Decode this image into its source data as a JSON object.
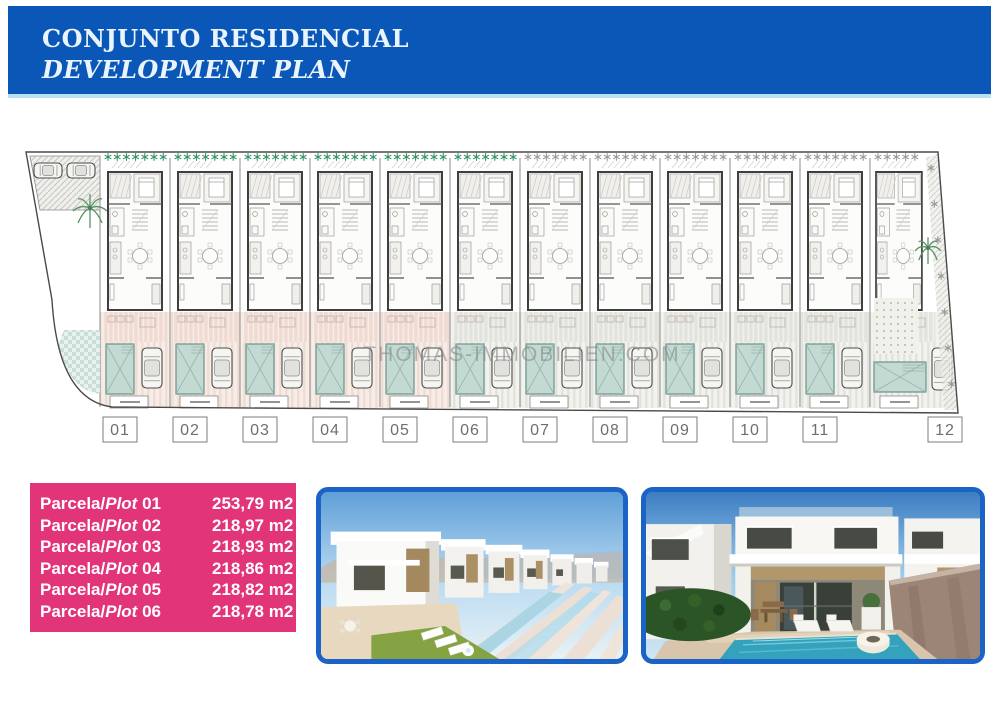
{
  "header": {
    "title_line1": "CONJUNTO RESIDENCIAL",
    "title_line2": "DEVELOPMENT PLAN",
    "bg_color": "#0a57b7",
    "accent_color": "#b7e0f1",
    "text_color": "#eaf4fc"
  },
  "site_plan": {
    "watermark": "THOMAS-IMMOBILIEN.COM",
    "colors": {
      "star_green": "#2f9466",
      "star_gray": "#9b9b9b",
      "pool_fill": "#c3dad3",
      "pool_stroke": "#6a938b",
      "boundary": "#4a4a4a",
      "phase_pink": "#f7ece6",
      "phase_gray": "#f2f2ef"
    },
    "units": [
      {
        "number": "01",
        "ground": "pink",
        "stars": "green"
      },
      {
        "number": "02",
        "ground": "pink",
        "stars": "green"
      },
      {
        "number": "03",
        "ground": "pink",
        "stars": "green"
      },
      {
        "number": "04",
        "ground": "pink",
        "stars": "green"
      },
      {
        "number": "05",
        "ground": "pink",
        "stars": "green"
      },
      {
        "number": "06",
        "ground": "gray",
        "stars": "green"
      },
      {
        "number": "07",
        "ground": "gray",
        "stars": "gray"
      },
      {
        "number": "08",
        "ground": "gray",
        "stars": "gray"
      },
      {
        "number": "09",
        "ground": "gray",
        "stars": "gray"
      },
      {
        "number": "10",
        "ground": "gray",
        "stars": "gray"
      },
      {
        "number": "11",
        "ground": "gray",
        "stars": "gray"
      },
      {
        "number": "12",
        "ground": "gray",
        "stars": "gray"
      }
    ]
  },
  "plot_table": {
    "bg_color": "#e23478",
    "rows": [
      {
        "prefix": "Parcela/",
        "word": "Plot",
        "num": "01",
        "area": "253,79 m2"
      },
      {
        "prefix": "Parcela/",
        "word": "Plot",
        "num": "02",
        "area": "218,97 m2"
      },
      {
        "prefix": "Parcela/",
        "word": "Plot",
        "num": "03",
        "area": "218,93 m2"
      },
      {
        "prefix": "Parcela/",
        "word": "Plot",
        "num": "04",
        "area": "218,86 m2"
      },
      {
        "prefix": "Parcela/",
        "word": "Plot",
        "num": "05",
        "area": "218,82 m2"
      },
      {
        "prefix": "Parcela/",
        "word": "Plot",
        "num": "06",
        "area": "218,78 m2"
      }
    ]
  },
  "photos": {
    "left_name": "villas-row-render",
    "right_name": "pool-terrace-render",
    "frame_color": "#1b64c6"
  }
}
